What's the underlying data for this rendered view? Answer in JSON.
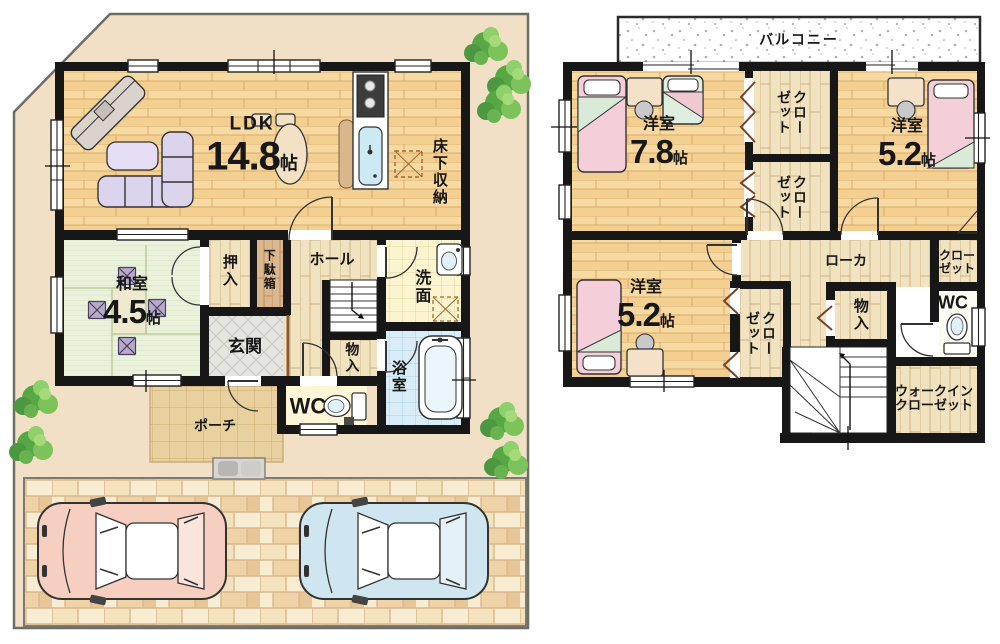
{
  "floor1": {
    "ldk": {
      "name": "LDK",
      "num": "14.8",
      "unit": "帖"
    },
    "washitsu": {
      "name": "和室",
      "num": "4.5",
      "unit": "帖"
    },
    "yukashita_shunou": "床下収納",
    "oshiire": "押入",
    "getabako": "下駄箱",
    "hall": "ホール",
    "senmen": "洗面",
    "genkan": "玄関",
    "monoire": "物入",
    "wc": "WC",
    "yokushitsu": "浴室",
    "porch": "ポーチ"
  },
  "floor2": {
    "balcony": "バルコニー",
    "bedroom1": {
      "name": "洋室",
      "num": "7.8",
      "unit": "帖"
    },
    "bedroom2": {
      "name": "洋室",
      "num": "5.2",
      "unit": "帖"
    },
    "bedroom3": {
      "name": "洋室",
      "num": "5.2",
      "unit": "帖"
    },
    "closet_a": "クローゼット",
    "closet_b": "クローゼット",
    "closet_c": "クローゼット",
    "closet_d": "クローゼット",
    "roka": "ローカ",
    "monoire": "物入",
    "wc": "WC",
    "walkin_closet": "ウォークインクローゼット"
  },
  "colors": {
    "site_fill": "#f2e0c6",
    "wall": "#171717",
    "wood_floor": "#f7d9a2",
    "hall_floor": "#f1e3c0",
    "tatami": "#eaf2dc",
    "wash_tile": "#fcf4cf",
    "bath_tile": "#d8edf8",
    "car_pink": "#f7cfc0",
    "car_blue": "#cfe6f0",
    "tree_green": "#5fae4a"
  }
}
